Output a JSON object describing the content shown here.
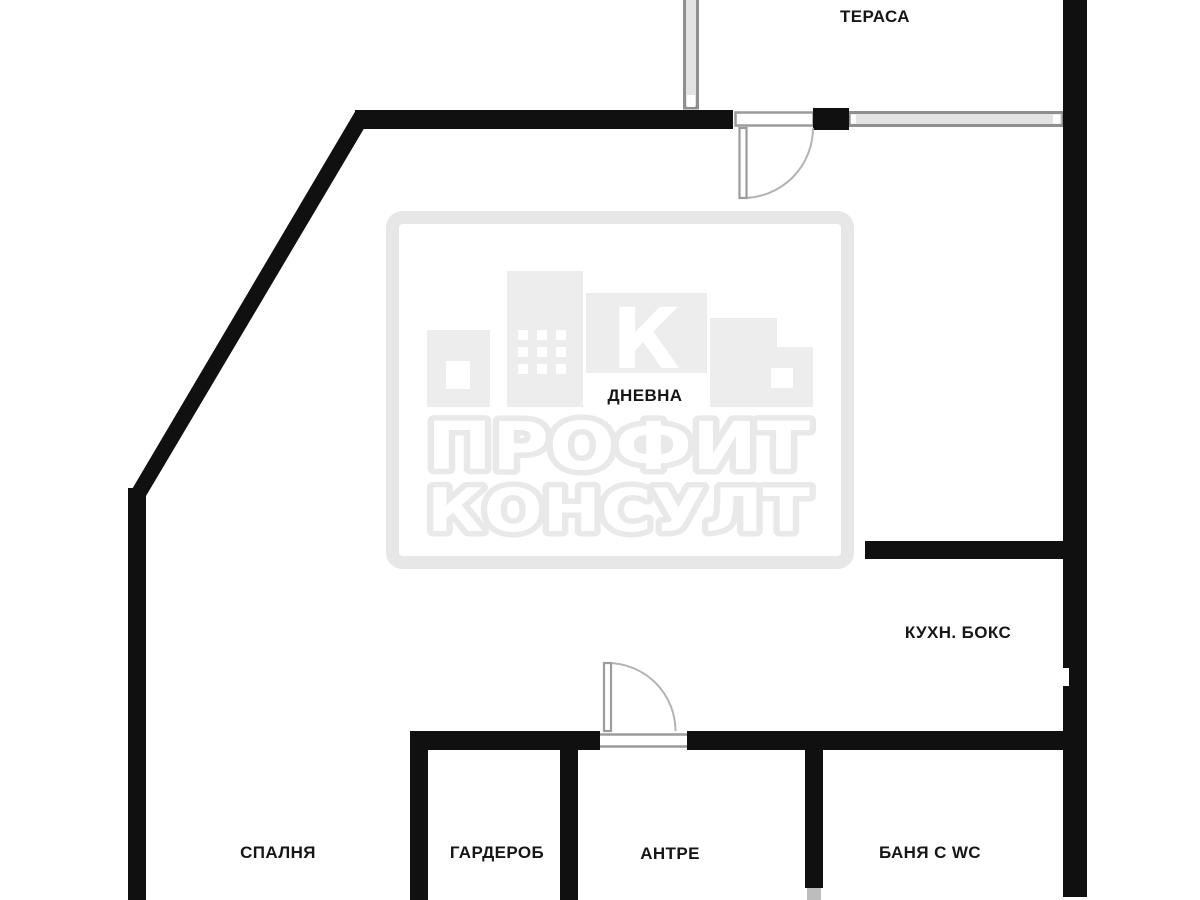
{
  "rooms": [
    {
      "id": "terrace",
      "label": "ТЕРАСА"
    },
    {
      "id": "living",
      "label": "ДНЕВНА"
    },
    {
      "id": "kitchen",
      "label": "КУХН. БОКС"
    },
    {
      "id": "bedroom",
      "label": "СПАЛНЯ"
    },
    {
      "id": "wardrobe",
      "label": "ГАРДЕРОБ"
    },
    {
      "id": "hall",
      "label": "АНТРЕ"
    },
    {
      "id": "bath",
      "label": "БАНЯ С WC"
    }
  ],
  "watermark": {
    "logo_letter": "К",
    "line1": "ПРОФИТ",
    "line2": "КОНСУЛТ"
  },
  "colors": {
    "background": "#ffffff",
    "wall": "#101010",
    "glazing_line": "#8f8f8f",
    "glazing_fill": "#e3e3e3",
    "threshold_line": "#9c9c9c",
    "door_arc": "#b3b3b3",
    "watermark_gray": "#ededed",
    "watermark_frame": "#e7e7e7",
    "label_text": "#161616"
  }
}
